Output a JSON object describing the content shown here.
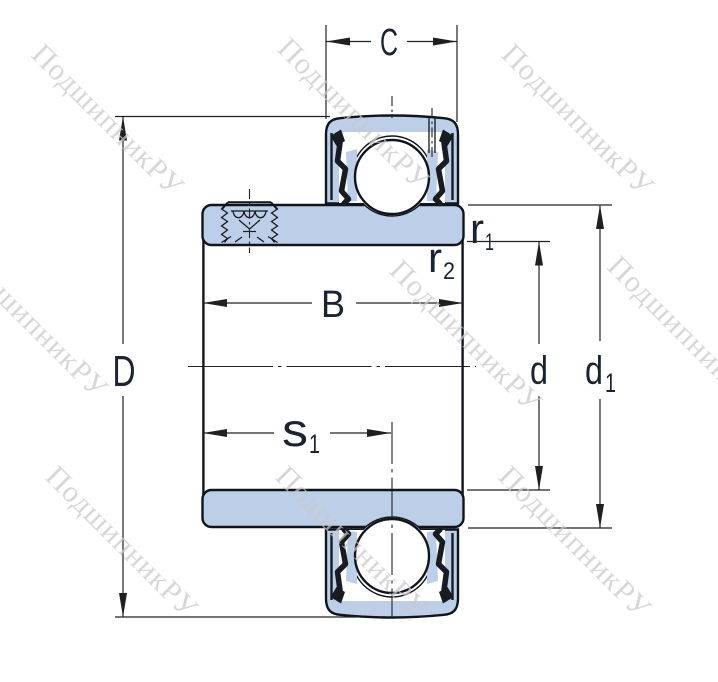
{
  "watermark": {
    "text": "ПодшипникРУ"
  },
  "dimension_labels": {
    "C": "C",
    "D": "D",
    "B": "B",
    "d": "d",
    "s1": {
      "base": "s",
      "sub": "1"
    },
    "r1": {
      "base": "r",
      "sub": "1"
    },
    "r2": {
      "base": "r",
      "sub": "2"
    },
    "d1": {
      "base": "d",
      "sub": "1"
    }
  },
  "colors": {
    "bearing_fill": "#bdcee9",
    "outline": "#10151c",
    "seal": "#171b22",
    "dimension_line": "#202020",
    "label_text": "#1b2330",
    "watermark": "#c9c9c9",
    "background": "#ffffff"
  }
}
